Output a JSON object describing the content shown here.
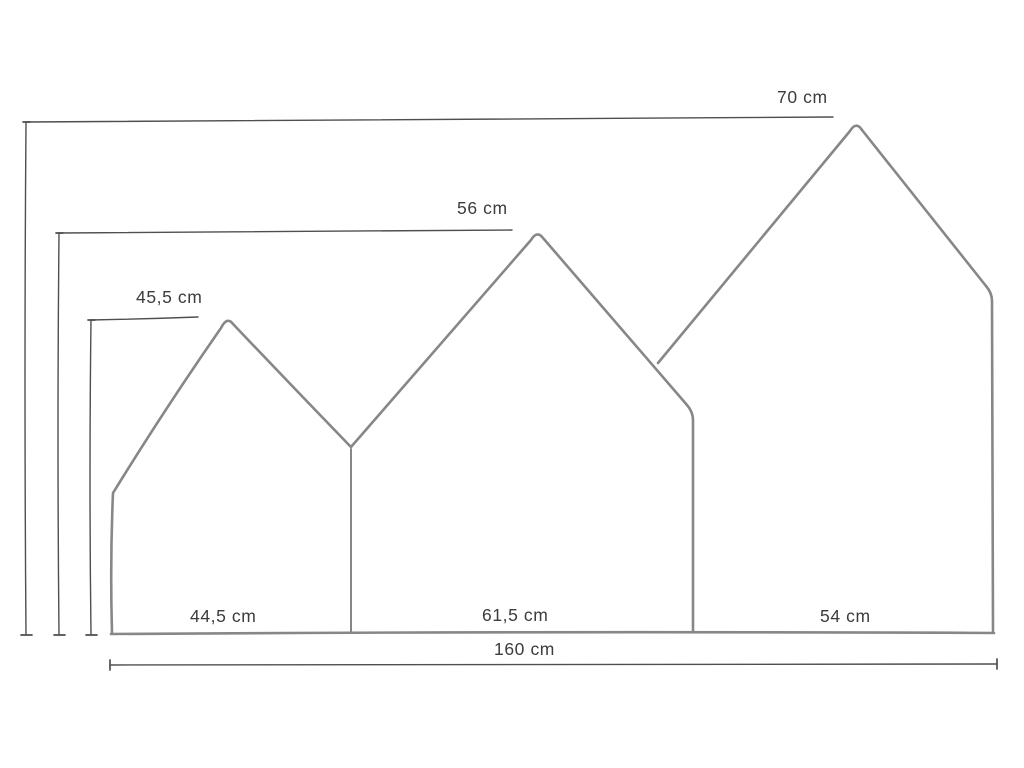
{
  "diagram": {
    "type": "dimension-drawing",
    "description": "Technical drawing of a three-house-shaped panel (headboard) with dimension lines",
    "unit": "cm",
    "panels": [
      {
        "id": "small-house",
        "position": "left",
        "width_label": "44,5 cm",
        "height_label": "45,5 cm"
      },
      {
        "id": "medium-house",
        "position": "center",
        "width_label": "61,5 cm",
        "height_label": "56 cm"
      },
      {
        "id": "large-house",
        "position": "right",
        "width_label": "54 cm",
        "height_label": "70 cm"
      }
    ],
    "total_width_label": "160 cm",
    "colors": {
      "outline": "#878787",
      "dimension_line": "#4f4f4f",
      "text": "#3c3c3c",
      "background": "#ffffff"
    }
  }
}
